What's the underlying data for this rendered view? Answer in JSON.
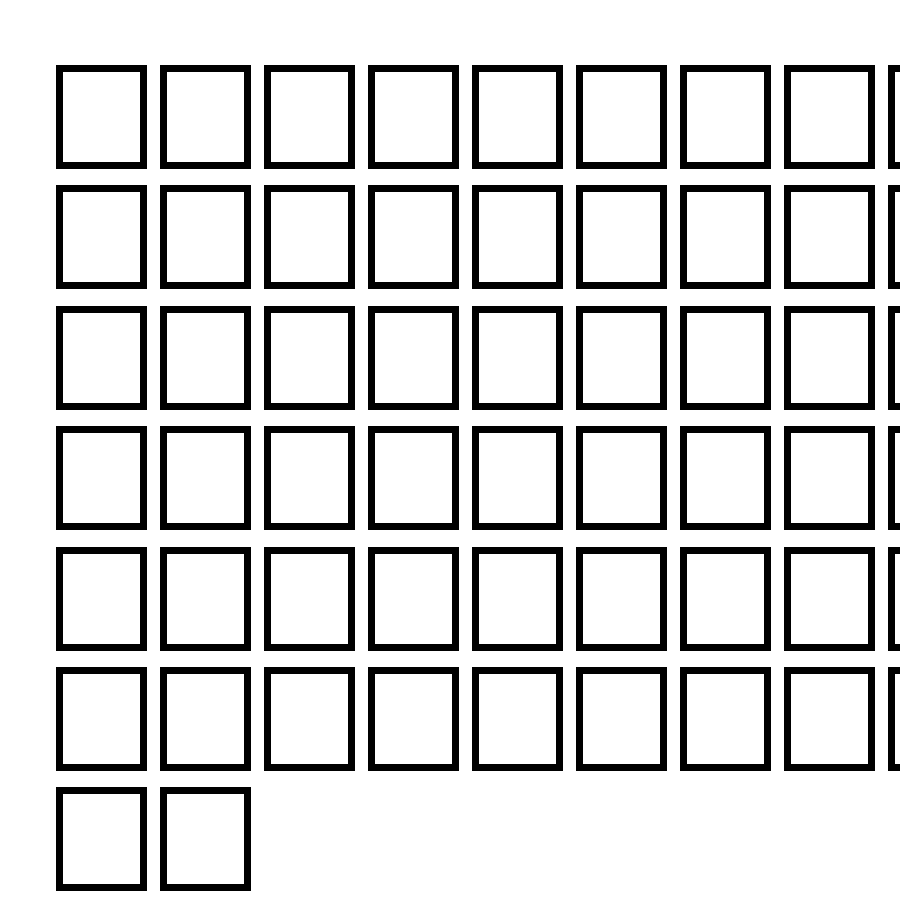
{
  "page": {
    "background_color": "#ffffff",
    "width_px": 900,
    "height_px": 900
  },
  "glyph_grid": {
    "description": "grid of empty missing-glyph (tofu) boxes",
    "border_color": "#000000",
    "border_thickness_px": 7,
    "box_outer_width_px": 91,
    "box_outer_height_px": 104,
    "column_pitch_px": 104,
    "row_pitch_px": 120.4,
    "origin_x_px": 56,
    "origin_y_px": 65,
    "columns_per_full_row": 9,
    "row_box_counts": [
      9,
      9,
      9,
      9,
      9,
      9,
      2
    ],
    "total_boxes": 56,
    "ninth_column_clipped_by_right_edge": true
  }
}
